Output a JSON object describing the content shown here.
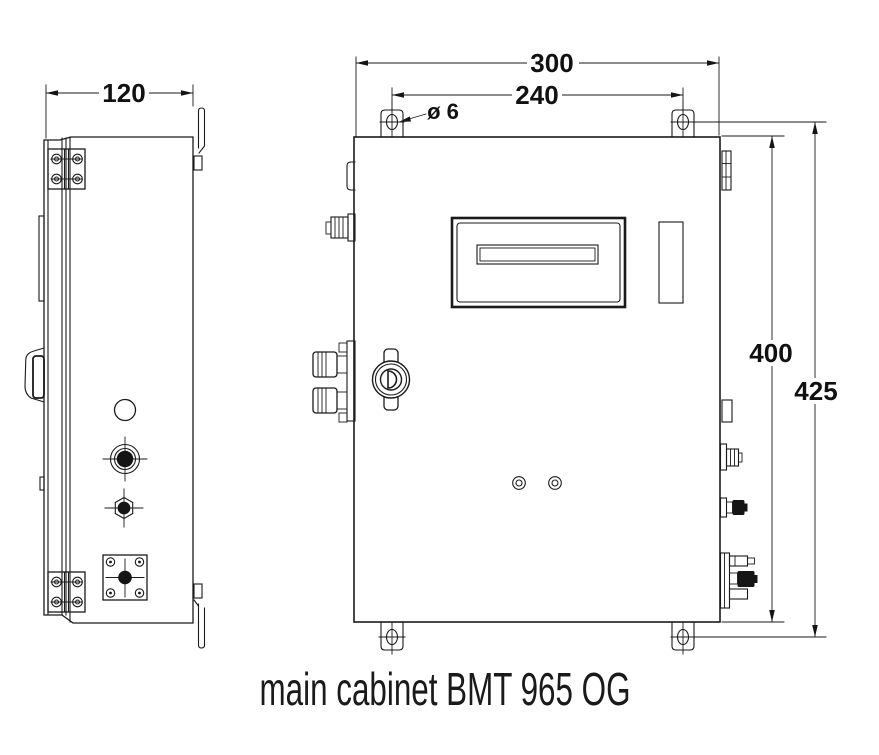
{
  "page": {
    "background": "#ffffff",
    "line_color": "#1a1a1a"
  },
  "caption": "main cabinet BMT 965 OG",
  "dimensions": {
    "depth": "120",
    "overall_width": "300",
    "mounting_hole_spacing_horizontal": "240",
    "mounting_hole_diameter": "ø 6",
    "body_height": "400",
    "mounting_hole_spacing_vertical": "425"
  }
}
